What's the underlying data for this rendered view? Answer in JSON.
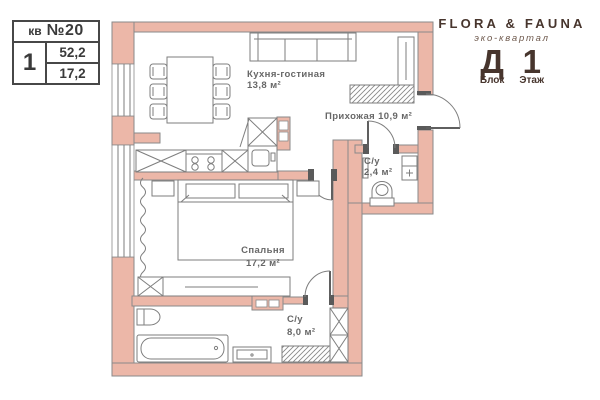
{
  "title_block": {
    "unit_label": "кв",
    "unit_number": "№20",
    "rooms": "1",
    "area_total": "52,2",
    "area_living": "17,2"
  },
  "brand": {
    "name": "FLORA & FAUNA",
    "subtitle": "эко-квартал",
    "block_value": "Д",
    "floor_value": "1",
    "block_label": "Блок",
    "floor_label": "Этаж"
  },
  "rooms": {
    "kitchen_living": {
      "name": "Кухня-гостиная",
      "area": "13,8 м²"
    },
    "hallway": {
      "name": "Прихожая 10,9 м²"
    },
    "bathroom_small": {
      "name": "С/у",
      "area": "2,4 м²"
    },
    "bedroom": {
      "name": "Спальня",
      "area": "17,2 м²"
    },
    "bathroom_big": {
      "name": "С/у",
      "area": "8,0 м²"
    }
  },
  "colors": {
    "wall": "#ECB7A8",
    "outline": "#8A8A8A",
    "furniture": "#7E7E7E",
    "label": "#676767",
    "brand_brown": "#47352D",
    "title_text": "#3A3A3A"
  }
}
